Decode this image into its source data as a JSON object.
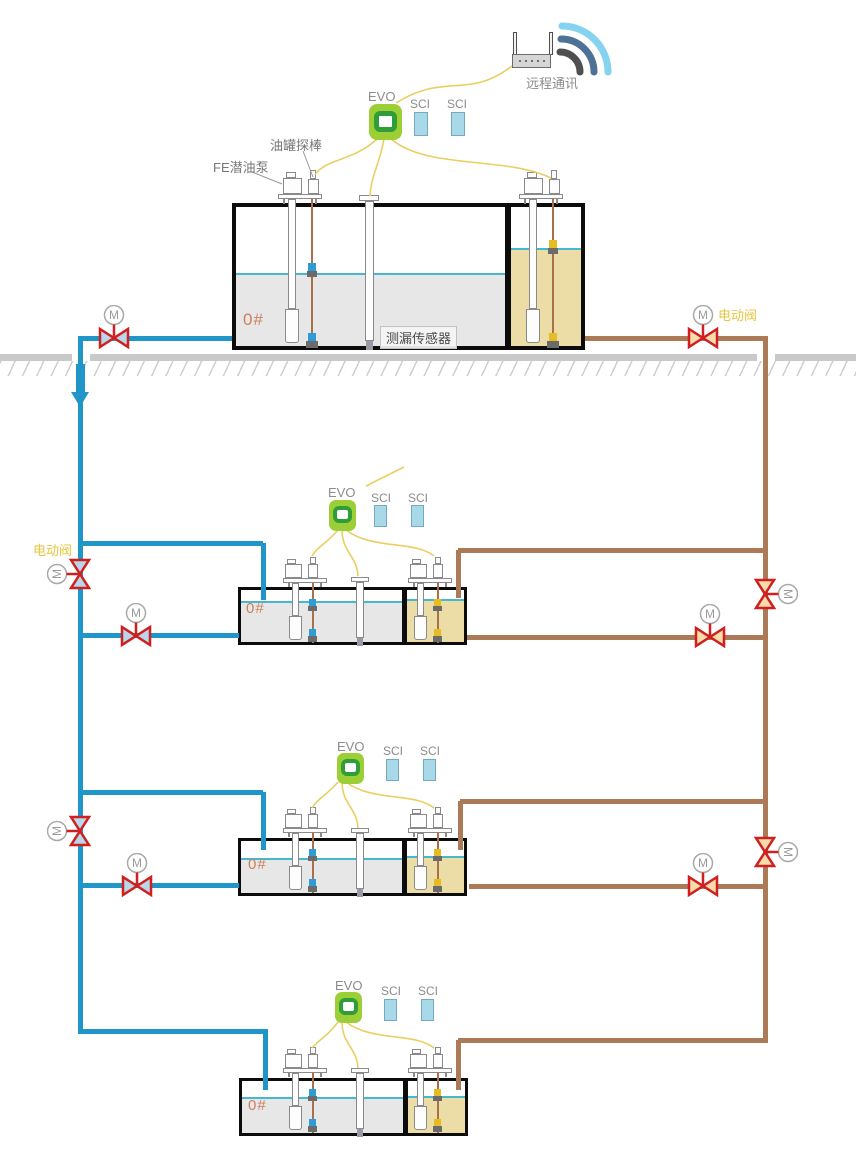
{
  "labels": {
    "remote_comm": "远程通讯",
    "evo": "EVO",
    "sci": "SCI",
    "tank_probe": "油罐探棒",
    "fe_pump": "FE潜油泵",
    "leak_sensor": "测漏传感器",
    "fuel_grade": "0#",
    "electric_valve": "电动阀",
    "motor": "M"
  },
  "colors": {
    "pipe_supply_blue": "#2095c8",
    "pipe_return_brown": "#ad7a58",
    "valve_red": "#cf1f1f",
    "valve_fill_blue": "#b9d6ea",
    "valve_fill_tan": "#f8dcab",
    "cable_yellow": "#e9cf62",
    "evo_green": "#9ccf35",
    "evo_ring_green": "#2f9e38",
    "sci_blue": "#a7d9e8",
    "fuel_gray": "#e7e7e7",
    "fuel_yellow": "#ecdda6",
    "liquid_line_cyan": "#45b8cf",
    "label_gold": "#e6c63e",
    "grade_orange": "#cd7f5a",
    "ground_gray": "#c9c9c9"
  },
  "counts": {
    "tanks": 4,
    "evo_units": 4,
    "sci_modules": 8,
    "motor_valves": 10
  }
}
